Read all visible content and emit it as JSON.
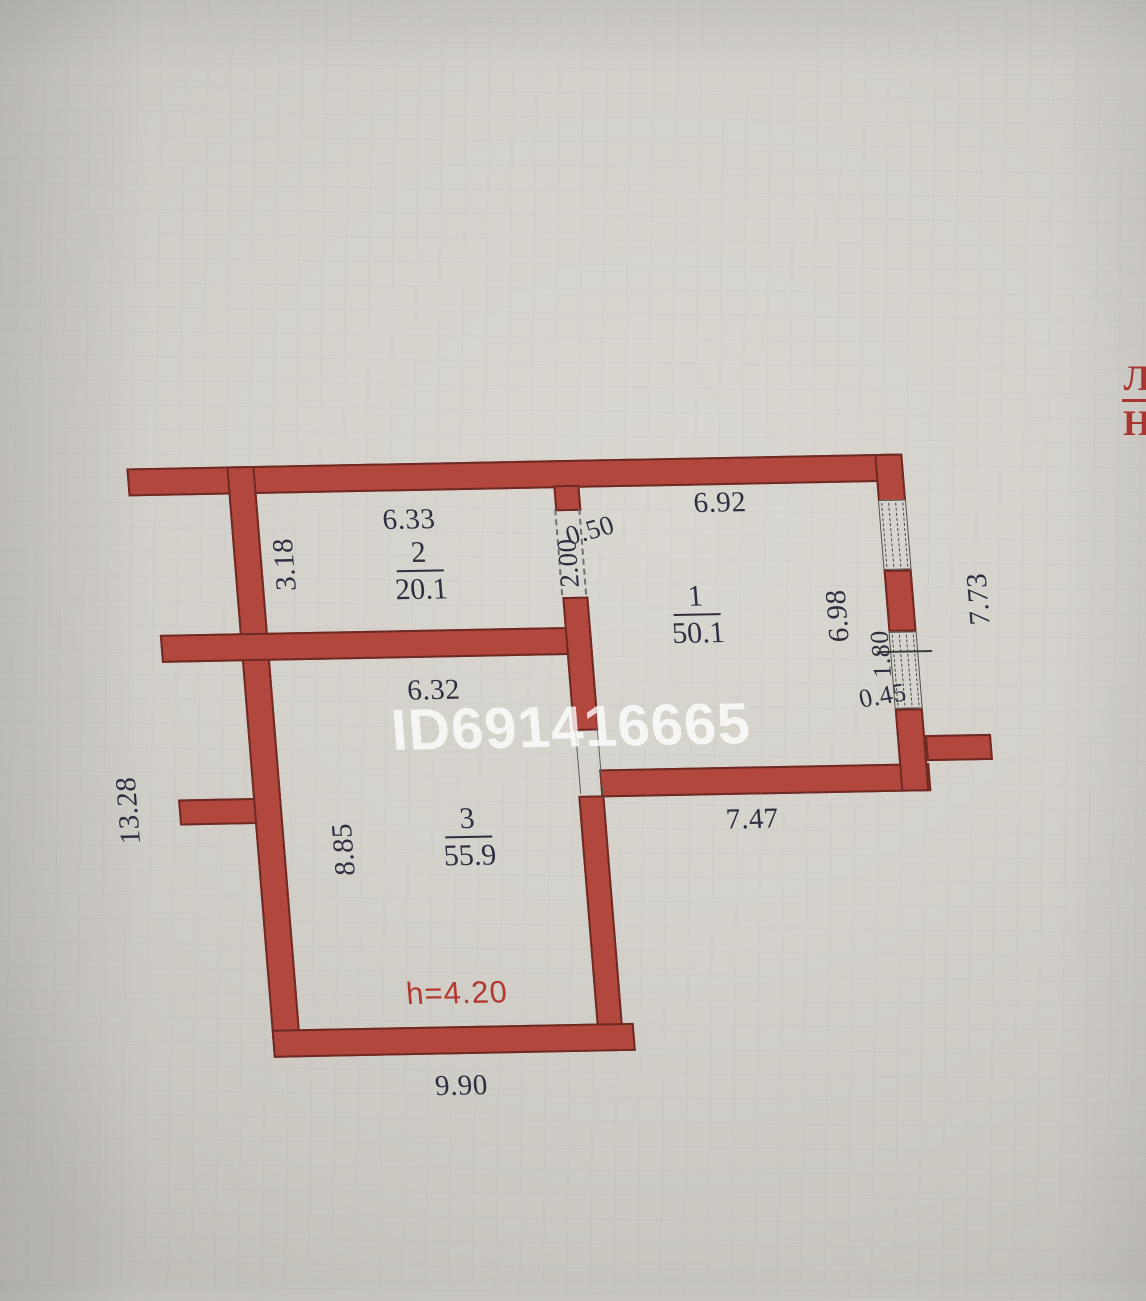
{
  "plan": {
    "watermark": "ID691416665",
    "corner_mark": {
      "top": "Л",
      "bottom": "Н"
    },
    "height_note": "h=4.20",
    "rooms": [
      {
        "number": "1",
        "area": "50.1"
      },
      {
        "number": "2",
        "area": "20.1"
      },
      {
        "number": "3",
        "area": "55.9"
      }
    ],
    "dimensions": {
      "room2_top": "6.33",
      "room2_left": "3.18",
      "door_width": "0.50",
      "door_opening": "2.00",
      "room1_top": "6.92",
      "room1_right_inner": "6.98",
      "right_outer": "7.73",
      "window_width": "1.80",
      "window_offset": "0.45",
      "room3_top": "6.32",
      "room3_left": "8.85",
      "room1_bottom": "7.47",
      "left_outer": "13.28",
      "room3_bottom": "9.90"
    },
    "colors": {
      "wall_fill": "#b1473d",
      "wall_outline": "#6d2a23",
      "dimension_text": "#2e2e40",
      "accent_red": "#b2392f",
      "paper": "#d3d0ca",
      "watermark": "rgba(255,255,255,0.78)"
    }
  }
}
